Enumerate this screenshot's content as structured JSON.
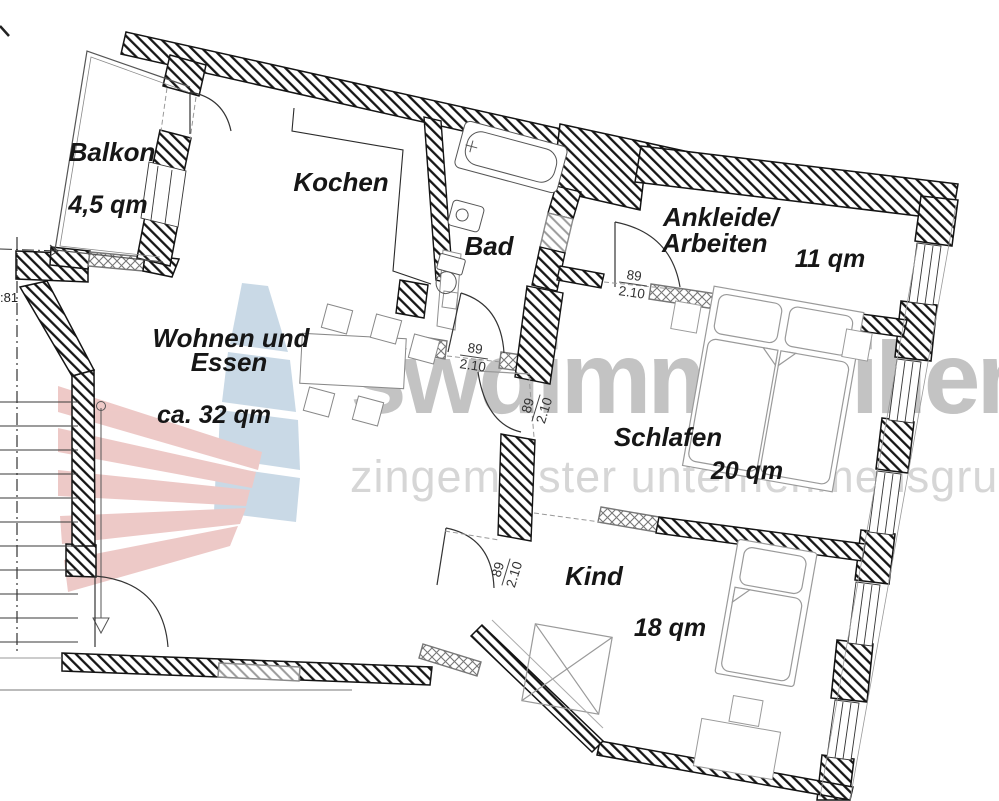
{
  "plan": {
    "rooms": [
      {
        "id": "balkon",
        "label": "Balkon",
        "area": "4,5 qm"
      },
      {
        "id": "kochen",
        "label": "Kochen"
      },
      {
        "id": "bad",
        "label": "Bad"
      },
      {
        "id": "wohnen",
        "line1": "Wohnen und",
        "line2": "Essen",
        "area": "ca. 32 qm"
      },
      {
        "id": "ankleide",
        "line1": "Ankleide/",
        "line2": "Arbeiten",
        "area": "11 qm"
      },
      {
        "id": "schlafen",
        "label": "Schlafen",
        "area": "20 qm"
      },
      {
        "id": "kind",
        "label": "Kind",
        "area": "18 qm"
      }
    ],
    "doors": [
      {
        "id": "ankleide-door",
        "width": "89",
        "height": "2.10"
      },
      {
        "id": "bad-door",
        "width": "89",
        "height": "2.10"
      },
      {
        "id": "wohnen-door",
        "width": "89",
        "height": "2.10"
      },
      {
        "id": "kind-door",
        "width": "89",
        "height": "2.10"
      }
    ],
    "stair_dimension": ":81"
  },
  "watermark": {
    "brand": "swdimmobilien",
    "tagline": "zingemeister unternehmensgruppe"
  },
  "colors": {
    "wall_line": "#141414",
    "furniture_line": "#909090",
    "watermark_brand": "#bdbdbd",
    "watermark_tagline": "#d2d2d2",
    "logo_red": "#e7b4b2",
    "logo_blue": "#b5cbdc"
  }
}
